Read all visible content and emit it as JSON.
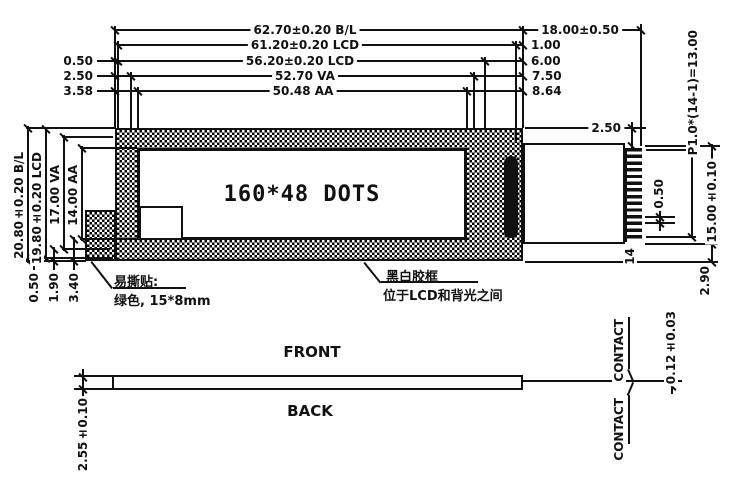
{
  "display": {
    "text": "160*48 DOTS"
  },
  "dims_top": {
    "bl_width": "62.70±0.20 B/L",
    "tab_width": "18.00±0.50",
    "lcd_outer": "61.20±0.20 LCD",
    "off_100": "1.00",
    "lcd_inner": "56.20±0.20 LCD",
    "off_600": "6.00",
    "left_off_050": "0.50",
    "va_width": "52.70 VA",
    "off_750": "7.50",
    "left_off_250": "2.50",
    "aa_width": "50.48 AA",
    "off_864": "8.64",
    "left_off_358": "3.58"
  },
  "dims_left": {
    "bl_height": "20.80±0.20 B/L",
    "lcd_height": "19.80±0.20 LCD",
    "va_height": "17.00 VA",
    "aa_height": "14.00 AA",
    "bottom_050": "0.50",
    "bottom_190": "1.90",
    "bottom_340": "3.40"
  },
  "dims_right": {
    "top_offset": "2.50",
    "pitch": "P1.0*(14-1)=13.00",
    "tab_height": "15.00±0.10",
    "pin_width": "0.50",
    "bottom_offset": "2.90",
    "pin_count": "14"
  },
  "side_view": {
    "front_label": "FRONT",
    "back_label": "BACK",
    "thickness": "2.55±0.10",
    "contact_thickness": "0.12±0.03",
    "contact_top": "CONTACT",
    "contact_bottom": "CONTACT"
  },
  "notes": {
    "sticker_line1": "易撕贴:",
    "sticker_line2": "绿色, 15*8mm",
    "frame_line1": "黑白胶框",
    "frame_line2": "位于LCD和背光之间"
  }
}
